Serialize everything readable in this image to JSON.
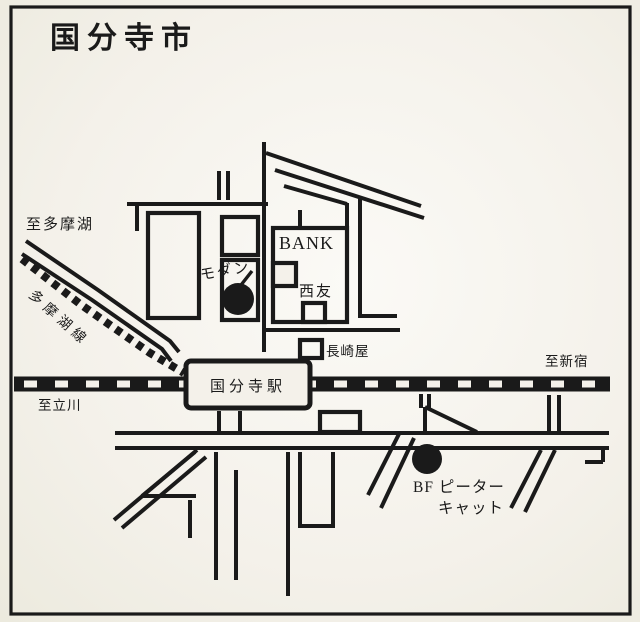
{
  "page": {
    "title": "国分寺市"
  },
  "map": {
    "colors": {
      "paper": "#f4f1ea",
      "ink": "#1a1a1a"
    },
    "labels": {
      "to_tamako": "至多摩湖",
      "tamako_line": "多摩湖線",
      "to_tachikawa": "至立川",
      "to_shinjuku": "至新宿",
      "bank": "BANK",
      "modern": "モダン",
      "seiyu": "西友",
      "nagasakiya": "長崎屋",
      "station": "国分寺駅",
      "peter_cat_line1": "BF ピーター",
      "peter_cat_line2": "キャット"
    },
    "pois": [
      {
        "name": "モダン",
        "marker": "filled-circle"
      },
      {
        "name": "BF ピーターキャット",
        "marker": "filled-circle"
      }
    ]
  }
}
